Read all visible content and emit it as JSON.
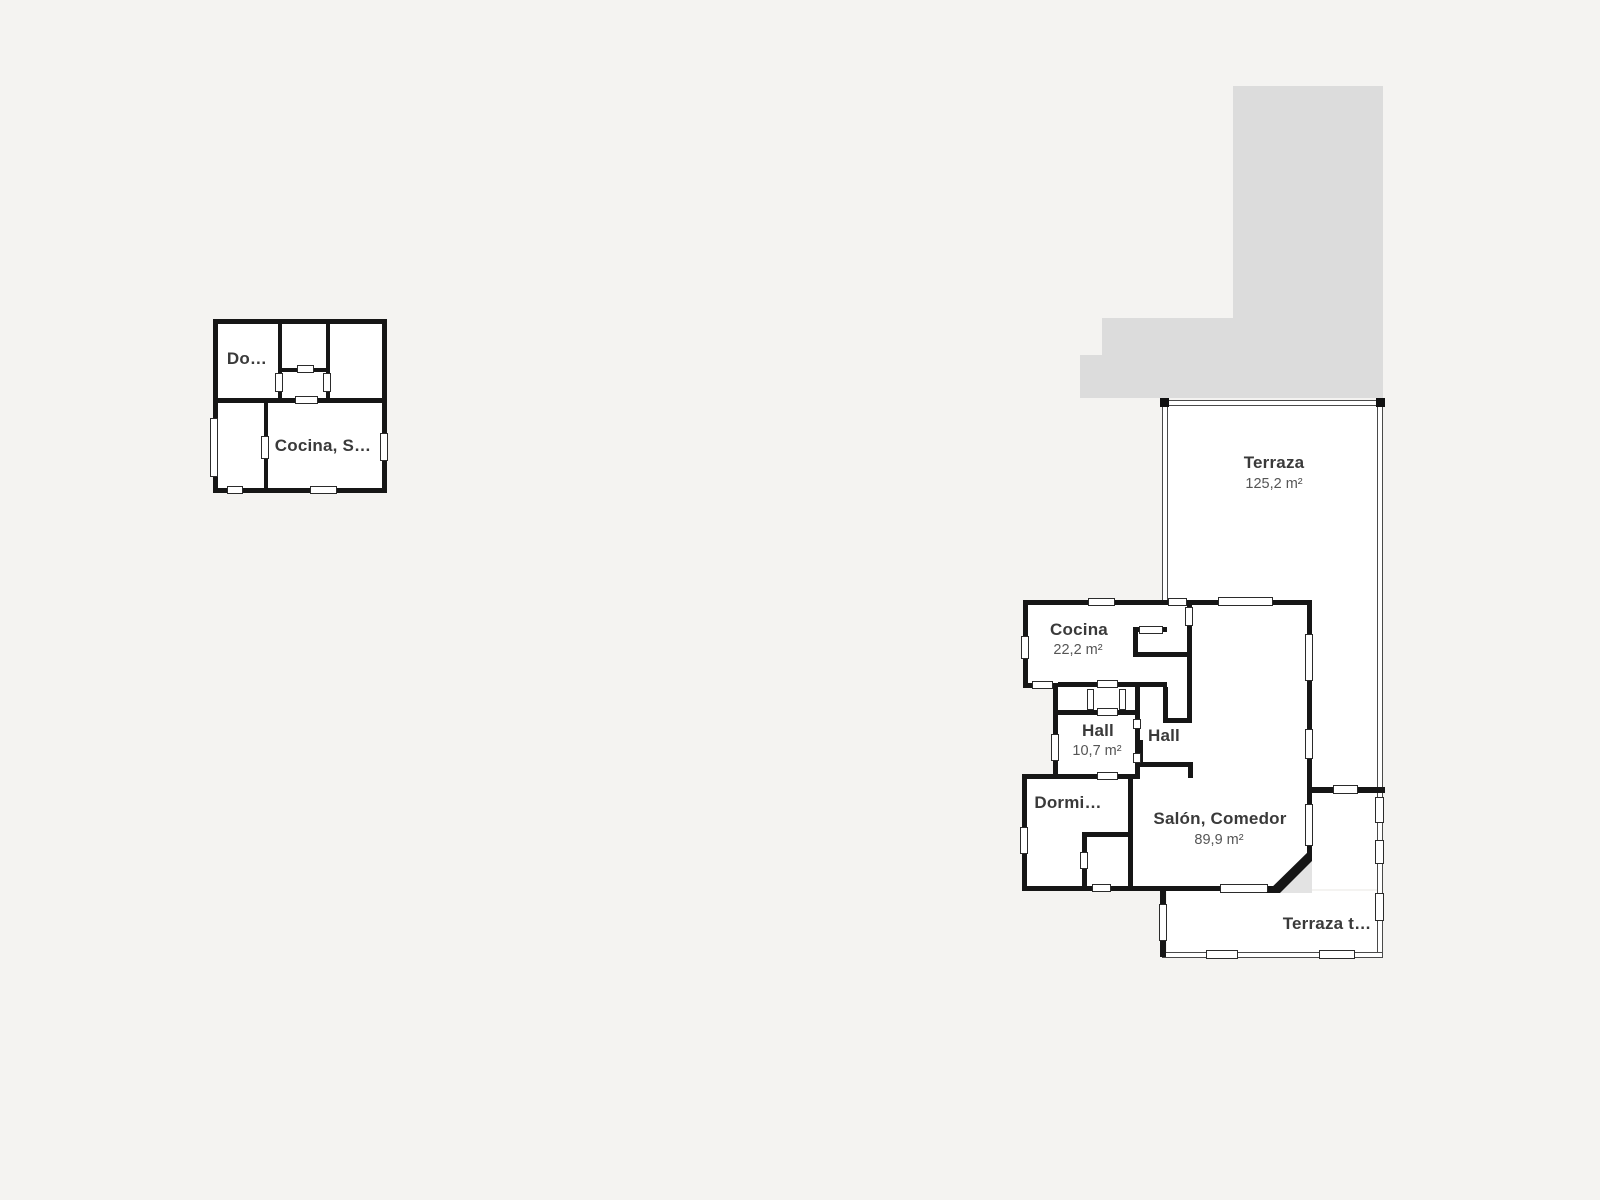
{
  "colors": {
    "background": "#f4f3f1",
    "wall": "#161616",
    "silhouette": "#dcdcdc",
    "room_fill": "#ffffff",
    "label": "#3a3a3a",
    "area_label": "#555555",
    "corner_triangle": "#e3e3e3"
  },
  "plan_small": {
    "fills": [
      [
        216,
        322,
        168,
        168
      ]
    ],
    "walls": [
      [
        213,
        319,
        174,
        5
      ],
      [
        213,
        488,
        174,
        5
      ],
      [
        213,
        319,
        5,
        174
      ],
      [
        382,
        319,
        5,
        174
      ],
      [
        278,
        319,
        4,
        84
      ],
      [
        326,
        319,
        4,
        84
      ],
      [
        278,
        368,
        52,
        4
      ],
      [
        213,
        398,
        174,
        5
      ],
      [
        264,
        403,
        4,
        90
      ]
    ],
    "slots": [
      [
        210,
        418,
        8,
        59
      ],
      [
        380,
        433,
        8,
        28
      ],
      [
        227,
        486,
        16,
        8
      ],
      [
        310,
        486,
        27,
        8
      ],
      [
        297,
        365,
        17,
        8
      ],
      [
        295,
        396,
        23,
        8
      ],
      [
        275,
        373,
        8,
        19
      ],
      [
        323,
        373,
        8,
        19
      ],
      [
        261,
        436,
        8,
        23
      ]
    ],
    "labels": [
      {
        "text": "Do…",
        "x": 247,
        "y": 359,
        "cls": "title"
      },
      {
        "text": "Cocina, S…",
        "x": 323,
        "y": 446,
        "cls": "title"
      }
    ]
  },
  "plan_main": {
    "silhouette": [
      [
        1233,
        86,
        150,
        312
      ],
      [
        1102,
        318,
        131,
        80
      ],
      [
        1080,
        355,
        23,
        43
      ]
    ],
    "fills": [
      [
        1167,
        406,
        210,
        196
      ],
      [
        1312,
        602,
        65,
        186
      ],
      [
        1312,
        792,
        65,
        97
      ],
      [
        1167,
        891,
        210,
        61
      ],
      [
        1025,
        602,
        285,
        86
      ],
      [
        1055,
        688,
        252,
        90
      ],
      [
        1024,
        776,
        284,
        111
      ]
    ],
    "thin_walls": [
      [
        1162,
        400,
        221,
        6
      ],
      [
        1162,
        400,
        6,
        202
      ],
      [
        1377,
        400,
        6,
        390
      ],
      [
        1377,
        790,
        6,
        167
      ],
      [
        1162,
        952,
        221,
        6
      ]
    ],
    "corner_squares": [
      [
        1160,
        398,
        9,
        9
      ],
      [
        1376,
        398,
        9,
        9
      ]
    ],
    "walls": [
      [
        1023,
        600,
        287,
        5
      ],
      [
        1023,
        600,
        5,
        88
      ],
      [
        1023,
        683,
        35,
        5
      ],
      [
        1053,
        688,
        5,
        88
      ],
      [
        1022,
        774,
        118,
        5
      ],
      [
        1022,
        776,
        5,
        115
      ],
      [
        1022,
        886,
        253,
        5
      ],
      [
        1307,
        600,
        5,
        258
      ],
      [
        1160,
        889,
        6,
        68
      ],
      [
        1307,
        787,
        78,
        6
      ],
      [
        1058,
        682,
        109,
        5
      ],
      [
        1058,
        710,
        77,
        5
      ],
      [
        1135,
        682,
        5,
        95
      ],
      [
        1133,
        627,
        34,
        5
      ],
      [
        1133,
        627,
        5,
        30
      ],
      [
        1133,
        652,
        59,
        5
      ],
      [
        1187,
        603,
        5,
        120
      ],
      [
        1163,
        687,
        5,
        34
      ],
      [
        1163,
        718,
        29,
        5
      ],
      [
        1140,
        762,
        52,
        5
      ],
      [
        1138,
        740,
        5,
        24
      ],
      [
        1188,
        762,
        5,
        16
      ],
      [
        1128,
        777,
        5,
        112
      ],
      [
        1082,
        832,
        48,
        5
      ],
      [
        1082,
        832,
        5,
        57
      ]
    ],
    "slots": [
      [
        1088,
        598,
        27,
        8
      ],
      [
        1168,
        598,
        19,
        8
      ],
      [
        1218,
        597,
        55,
        9
      ],
      [
        1021,
        636,
        8,
        23
      ],
      [
        1032,
        681,
        21,
        8
      ],
      [
        1051,
        734,
        8,
        27
      ],
      [
        1097,
        772,
        21,
        8
      ],
      [
        1020,
        827,
        8,
        27
      ],
      [
        1092,
        884,
        19,
        8
      ],
      [
        1220,
        884,
        48,
        9
      ],
      [
        1305,
        634,
        8,
        47
      ],
      [
        1305,
        729,
        8,
        30
      ],
      [
        1305,
        804,
        8,
        42
      ],
      [
        1333,
        785,
        25,
        9
      ],
      [
        1159,
        904,
        8,
        37
      ],
      [
        1097,
        680,
        21,
        8
      ],
      [
        1097,
        708,
        21,
        8
      ],
      [
        1087,
        689,
        7,
        21
      ],
      [
        1119,
        689,
        7,
        21
      ],
      [
        1133,
        719,
        8,
        10
      ],
      [
        1133,
        753,
        8,
        10
      ],
      [
        1139,
        626,
        24,
        8
      ],
      [
        1185,
        607,
        8,
        19
      ],
      [
        1080,
        852,
        8,
        17
      ],
      [
        1206,
        950,
        32,
        9
      ],
      [
        1319,
        950,
        36,
        9
      ],
      [
        1375,
        893,
        9,
        28
      ],
      [
        1375,
        840,
        9,
        24
      ],
      [
        1375,
        797,
        9,
        26
      ]
    ],
    "diagonal": {
      "black": [
        1266,
        848,
        46,
        45
      ],
      "gray": [
        1280,
        861,
        32,
        32
      ]
    },
    "labels": [
      {
        "text": "Terraza",
        "x": 1274,
        "y": 463,
        "cls": "title"
      },
      {
        "text": "125,2 m²",
        "x": 1274,
        "y": 484,
        "cls": "sub"
      },
      {
        "text": "Cocina",
        "x": 1079,
        "y": 630,
        "cls": "title"
      },
      {
        "text": "22,2 m²",
        "x": 1078,
        "y": 650,
        "cls": "sub"
      },
      {
        "text": "Hall",
        "x": 1098,
        "y": 731,
        "cls": "title"
      },
      {
        "text": "10,7 m²",
        "x": 1097,
        "y": 751,
        "cls": "sub"
      },
      {
        "text": "Hall",
        "x": 1164,
        "y": 736,
        "cls": "title"
      },
      {
        "text": "Dormi…",
        "x": 1068,
        "y": 803,
        "cls": "title"
      },
      {
        "text": "Salón, Comedor",
        "x": 1220,
        "y": 819,
        "cls": "title"
      },
      {
        "text": "89,9 m²",
        "x": 1219,
        "y": 840,
        "cls": "sub"
      },
      {
        "text": "Terraza t…",
        "x": 1327,
        "y": 924,
        "cls": "title"
      }
    ]
  }
}
